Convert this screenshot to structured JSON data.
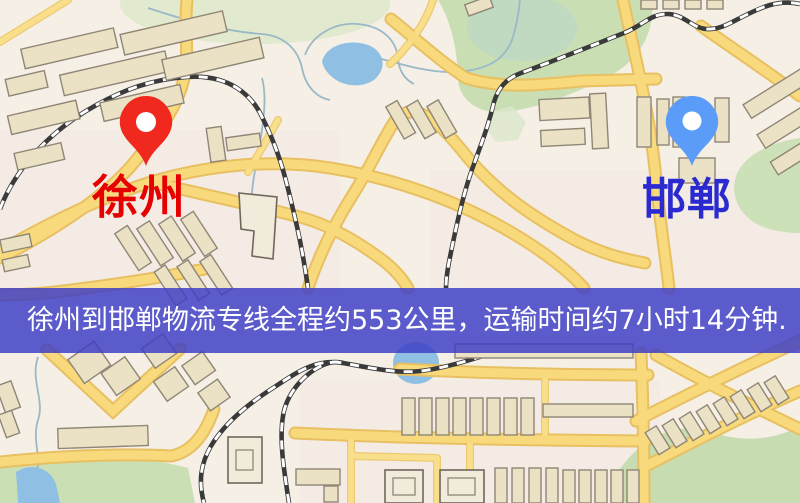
{
  "map": {
    "origin": {
      "name": "徐州",
      "marker_color": "#f0281e",
      "label_color": "#e60000"
    },
    "destination": {
      "name": "邯郸",
      "marker_color": "#5b9cf8",
      "label_color": "#2a2ad0"
    }
  },
  "banner": {
    "text": "徐州到邯郸物流专线全程约553公里，运输时间约7小时14分钟.",
    "background_color": "#3e3ec6",
    "text_color": "#ffffff"
  },
  "route": {
    "distance_text": "553公里",
    "duration_text": "7小时14分钟"
  }
}
